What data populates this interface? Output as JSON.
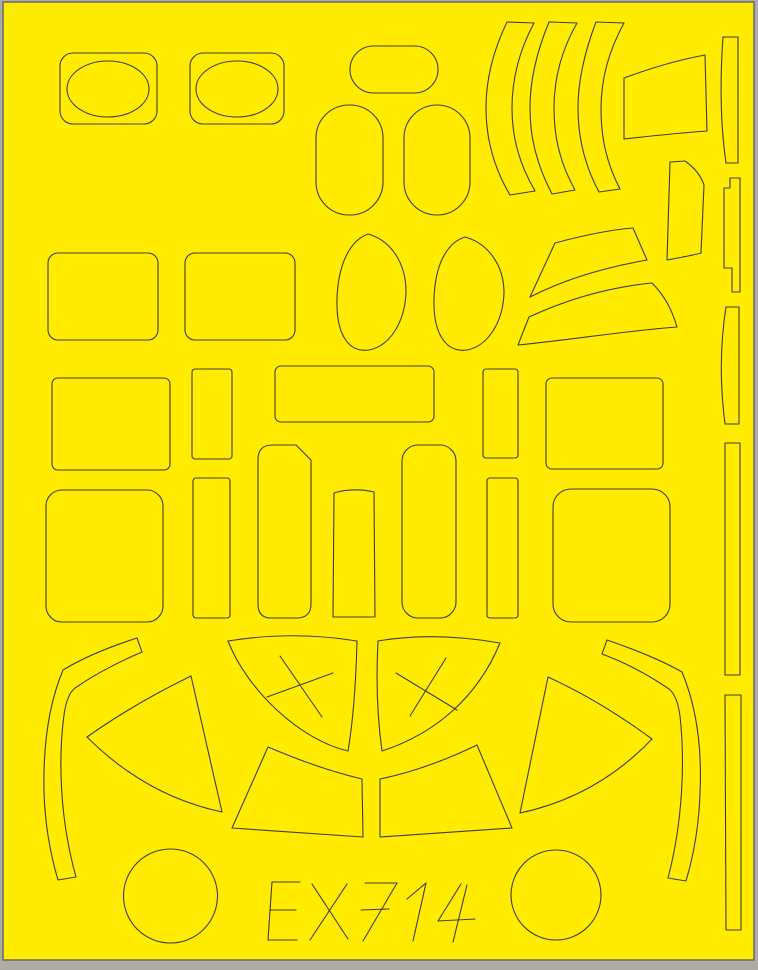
{
  "sheet": {
    "code": "EX714",
    "background_color": "#ffec00",
    "line_color": "#3f3e37",
    "margin_color": "#adaca7",
    "border_color": "#6b6a62",
    "width": 758,
    "height": 970,
    "area": {
      "x": 3,
      "y": 2,
      "width": 751,
      "height": 958
    },
    "code_glyph_lines": [
      [
        272,
        882,
        268,
        940
      ],
      [
        272,
        882,
        300,
        882
      ],
      [
        270,
        910,
        296,
        910
      ],
      [
        268,
        940,
        297,
        940
      ],
      [
        312,
        884,
        348,
        939
      ],
      [
        347,
        884,
        310,
        940
      ],
      [
        365,
        883,
        397,
        883
      ],
      [
        397,
        883,
        363,
        941
      ],
      [
        361,
        910,
        389,
        909
      ],
      [
        407,
        899,
        426,
        883
      ],
      [
        426,
        883,
        413,
        941
      ],
      [
        461,
        884,
        438,
        921
      ],
      [
        438,
        921,
        475,
        919
      ],
      [
        467,
        885,
        453,
        942
      ]
    ]
  },
  "shapes": [
    {
      "name": "oval-frame-left",
      "type": "rect",
      "x": 60,
      "y": 53,
      "width": 97,
      "height": 71,
      "rx": 13
    },
    {
      "name": "oval-cut-left",
      "type": "ellipse",
      "cx": 108,
      "cy": 89,
      "rx": 41,
      "ry": 28
    },
    {
      "name": "oval-frame-right",
      "type": "rect",
      "x": 190,
      "y": 53,
      "width": 94,
      "height": 71,
      "rx": 13
    },
    {
      "name": "oval-cut-right",
      "type": "ellipse",
      "cx": 237,
      "cy": 89,
      "rx": 41,
      "ry": 28
    },
    {
      "name": "capsule-horizontal",
      "type": "rect",
      "x": 350,
      "y": 46,
      "width": 88,
      "height": 47,
      "rx": 23.5
    },
    {
      "name": "capsule-vertical-left",
      "type": "rect",
      "x": 316,
      "y": 105,
      "width": 67,
      "height": 110,
      "rx": 33
    },
    {
      "name": "capsule-vertical-right",
      "type": "rect",
      "x": 404,
      "y": 105,
      "width": 66,
      "height": 110,
      "rx": 33
    },
    {
      "name": "crescent-strip-1",
      "type": "path",
      "d": "M507,22 C493,51 486,79 486,108 C486,140 494,168 510,195 L535,191 C520,165 512,139 512,108 C512,79 519,51 534,23 Z"
    },
    {
      "name": "crescent-strip-2",
      "type": "path",
      "d": "M549,22 C537,51 530,79 530,108 C530,140 538,167 552,194 L575,190 C561,165 554,139 554,108 C554,79 561,51 577,23 Z"
    },
    {
      "name": "crescent-strip-3",
      "type": "path",
      "d": "M596,22 C585,51 578,79 578,108 C578,139 585,166 599,192 L620,189 C607,164 601,139 601,109 C601,80 608,52 624,23 Z"
    },
    {
      "name": "wing-trapezoid-top-right",
      "type": "path",
      "d": "M624,78 C651,68 678,60 705,55 L707,131 C679,133 651,136 624,139 Z"
    },
    {
      "name": "wing-quad-small-right",
      "type": "path",
      "d": "M670,162 L685,161 C695,168 701,176 704,185 L701,253 C690,256 678,258 667,260 Z"
    },
    {
      "name": "edge-strip-1",
      "type": "path",
      "d": "M723,37 L738,37 L738,163 L726,163 C720,121 720,79 723,37 Z"
    },
    {
      "name": "edge-strip-notched",
      "type": "path",
      "d": "M730,178 L740,178 L740,292 L732,292 L732,268 L724,268 L724,188 L730,188 Z"
    },
    {
      "name": "edge-strip-2",
      "type": "path",
      "d": "M726,307 L739,307 L739,424 L725,424 C720,385 720,345 726,307 Z"
    },
    {
      "name": "edge-strip-3",
      "type": "path",
      "d": "M725,443 L740,443 L740,675 L725,675 Z"
    },
    {
      "name": "edge-strip-4",
      "type": "path",
      "d": "M725,695 L741,695 L741,930 L726,930 Z"
    },
    {
      "name": "rounded-rect-row2-left",
      "type": "rect",
      "x": 48,
      "y": 253,
      "width": 110,
      "height": 87,
      "rx": 10
    },
    {
      "name": "rounded-rect-row2-right",
      "type": "rect",
      "x": 185,
      "y": 253,
      "width": 110,
      "height": 87,
      "rx": 10
    },
    {
      "name": "egg-oval-left",
      "type": "path",
      "d": "M368,234 C390,240 406,262 406,292 C405,322 390,346 369,350 C347,353 336,332 337,299 C338,266 349,241 368,234 Z"
    },
    {
      "name": "egg-oval-right",
      "type": "path",
      "d": "M465,237 C487,243 504,264 504,293 C503,322 488,346 467,350 C445,353 433,332 434,299 C435,266 446,243 465,237 Z"
    },
    {
      "name": "wedge-upper-right",
      "type": "path",
      "d": "M555,243 C581,236 607,230 633,228 L647,260 C607,267 567,278 530,297 Z"
    },
    {
      "name": "wedge-lower-right",
      "type": "path",
      "d": "M529,317 C570,298 611,287 652,283 C665,296 672,310 677,327 C624,331 570,340 518,345 Z"
    },
    {
      "name": "rect-row3-left",
      "type": "rect",
      "x": 52,
      "y": 378,
      "width": 118,
      "height": 92,
      "rx": 6
    },
    {
      "name": "strip-row3-left",
      "type": "rect",
      "x": 192,
      "y": 369,
      "width": 40,
      "height": 90,
      "rx": 3
    },
    {
      "name": "rect-row3-wide",
      "type": "rect",
      "x": 275,
      "y": 366,
      "width": 159,
      "height": 56,
      "rx": 6
    },
    {
      "name": "strip-row3-mid",
      "type": "rect",
      "x": 483,
      "y": 369,
      "width": 35,
      "height": 89,
      "rx": 3
    },
    {
      "name": "rect-row3-right",
      "type": "rect",
      "x": 546,
      "y": 378,
      "width": 117,
      "height": 91,
      "rx": 6
    },
    {
      "name": "rounded-rect-row4-left",
      "type": "rect",
      "x": 46,
      "y": 490,
      "width": 117,
      "height": 132,
      "rx": 16
    },
    {
      "name": "strip-row4-left",
      "type": "rect",
      "x": 193,
      "y": 478,
      "width": 37,
      "height": 140,
      "rx": 3
    },
    {
      "name": "panel-beveled-corner",
      "type": "path",
      "d": "M272,445 L296,445 L311,460 L311,604 C311,613 306,618 297,618 L271,618 C262,618 258,613 258,604 L258,459 C258,450 263,445 272,445 Z"
    },
    {
      "name": "strip-row4-mid",
      "type": "path",
      "d": "M334,493 C347,489 361,489 374,492 L375,617 L333,617 Z"
    },
    {
      "name": "rounded-rect-tall",
      "type": "rect",
      "x": 402,
      "y": 445,
      "width": 54,
      "height": 173,
      "rx": 16
    },
    {
      "name": "strip-row4-right",
      "type": "rect",
      "x": 487,
      "y": 478,
      "width": 31,
      "height": 140,
      "rx": 3
    },
    {
      "name": "rounded-rect-row4-right",
      "type": "rect",
      "x": 553,
      "y": 489,
      "width": 117,
      "height": 133,
      "rx": 18
    },
    {
      "name": "curved-stick-left",
      "type": "path",
      "d": "M137,638 C106,648 81,659 63,670 C48,706 43,748 44,792 C45,824 50,853 58,880 L76,877 C60,820 58,760 64,715 C66,700 70,692 75,688 C94,675 116,663 142,652 Z"
    },
    {
      "name": "curved-stick-right",
      "type": "path",
      "d": "M607,640 C636,650 663,661 682,672 C697,708 702,750 700,793 C699,825 694,854 686,881 L668,878 C683,821 685,761 680,716 C678,701 674,693 669,689 C650,676 629,664 602,654 Z"
    },
    {
      "name": "canopy-wedge-left",
      "type": "path",
      "d": "M191,676 L222,812 C175,802 129,779 87,737 C121,713 156,693 191,676 Z"
    },
    {
      "name": "canopy-wedge-right",
      "type": "path",
      "d": "M548,677 C583,693 618,714 652,739 C612,781 567,803 520,813 Z"
    },
    {
      "name": "canopy-sector-left",
      "type": "path",
      "d": "M228,641 C271,634 314,634 357,641 C356,680 354,716 348,751 C300,740 247,690 228,641 Z"
    },
    {
      "name": "sector-left-cross-stroke-1",
      "type": "line",
      "x1": 280,
      "y1": 656,
      "x2": 322,
      "y2": 717
    },
    {
      "name": "sector-left-cross-stroke-2",
      "type": "line",
      "x1": 267,
      "y1": 697,
      "x2": 333,
      "y2": 673
    },
    {
      "name": "canopy-sector-right",
      "type": "path",
      "d": "M378,641 C419,634 460,636 500,643 C478,696 437,733 382,751 C377,715 376,678 378,641 Z"
    },
    {
      "name": "sector-right-cross-stroke-1",
      "type": "line",
      "x1": 396,
      "y1": 673,
      "x2": 457,
      "y2": 710
    },
    {
      "name": "sector-right-cross-stroke-2",
      "type": "line",
      "x1": 446,
      "y1": 658,
      "x2": 410,
      "y2": 716
    },
    {
      "name": "canopy-band-left",
      "type": "path",
      "d": "M268,747 C301,761 332,772 362,779 L363,837 C319,834 275,831 232,828 Z"
    },
    {
      "name": "canopy-band-right",
      "type": "path",
      "d": "M477,745 L512,828 C468,831 424,834 380,837 L380,779 C414,772 446,760 477,745 Z"
    },
    {
      "name": "circle-cut-left",
      "type": "circle",
      "cx": 170.5,
      "cy": 896,
      "r": 47
    },
    {
      "name": "circle-cut-right",
      "type": "circle",
      "cx": 556,
      "cy": 895,
      "r": 45
    }
  ]
}
